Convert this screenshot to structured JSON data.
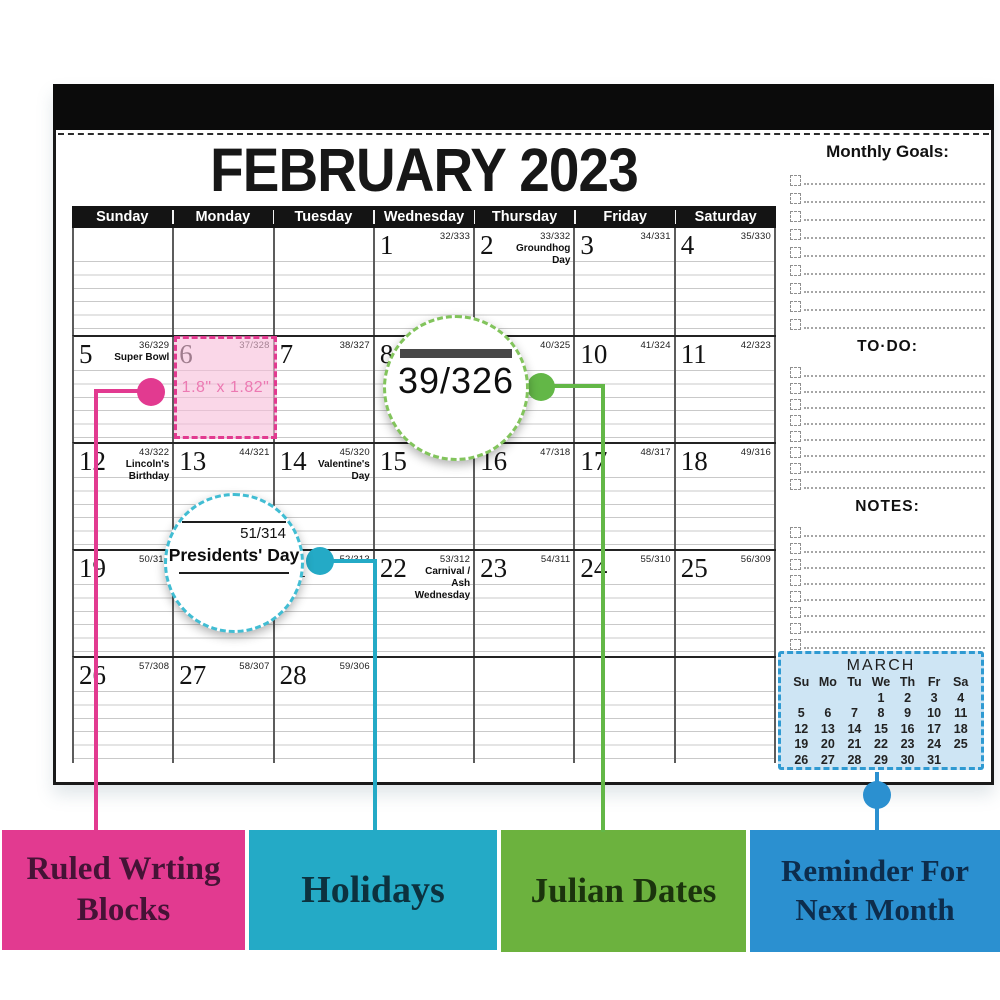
{
  "calendar": {
    "title": "FEBRUARY 2023",
    "weekdays": [
      "Sunday",
      "Monday",
      "Tuesday",
      "Wednesday",
      "Thursday",
      "Friday",
      "Saturday"
    ],
    "weeks": [
      [
        null,
        null,
        null,
        {
          "day": "1",
          "julian": "32/333"
        },
        {
          "day": "2",
          "julian": "33/332",
          "holiday": "Groundhog Day"
        },
        {
          "day": "3",
          "julian": "34/331"
        },
        {
          "day": "4",
          "julian": "35/330"
        }
      ],
      [
        {
          "day": "5",
          "julian": "36/329",
          "holiday": "Super Bowl"
        },
        {
          "day": "6",
          "julian": "37/328"
        },
        {
          "day": "7",
          "julian": "38/327"
        },
        {
          "day": "8",
          "julian": "39/326"
        },
        {
          "day": "9",
          "julian": "40/325"
        },
        {
          "day": "10",
          "julian": "41/324"
        },
        {
          "day": "11",
          "julian": "42/323"
        }
      ],
      [
        {
          "day": "12",
          "julian": "43/322",
          "holiday": "Lincoln's Birthday"
        },
        {
          "day": "13",
          "julian": "44/321"
        },
        {
          "day": "14",
          "julian": "45/320",
          "holiday": "Valentine's Day"
        },
        {
          "day": "15",
          "julian": "46/319"
        },
        {
          "day": "16",
          "julian": "47/318"
        },
        {
          "day": "17",
          "julian": "48/317"
        },
        {
          "day": "18",
          "julian": "49/316"
        }
      ],
      [
        {
          "day": "19",
          "julian": "50/315"
        },
        {
          "day": "20",
          "julian": "51/314",
          "holiday": "Presidents' Day"
        },
        {
          "day": "21",
          "julian": "52/313"
        },
        {
          "day": "22",
          "julian": "53/312",
          "holiday": "Carnival / Ash Wednesday"
        },
        {
          "day": "23",
          "julian": "54/311"
        },
        {
          "day": "24",
          "julian": "55/310"
        },
        {
          "day": "25",
          "julian": "56/309"
        }
      ],
      [
        {
          "day": "26",
          "julian": "57/308"
        },
        {
          "day": "27",
          "julian": "58/307"
        },
        {
          "day": "28",
          "julian": "59/306"
        },
        null,
        null,
        null,
        null
      ]
    ],
    "sidebar": {
      "sections": [
        {
          "heading": "Monthly Goals:",
          "lines": 9,
          "style": "big",
          "row": "h18"
        },
        {
          "heading": "TO·DO:",
          "lines": 8,
          "style": "mid",
          "row": "h16"
        },
        {
          "heading": "NOTES:",
          "lines": 8,
          "style": "mid",
          "row": "h16"
        }
      ],
      "march": {
        "title": "MARCH",
        "day_headers": [
          "Su",
          "Mo",
          "Tu",
          "We",
          "Th",
          "Fr",
          "Sa"
        ],
        "rows": [
          [
            "",
            "",
            "",
            "1",
            "2",
            "3",
            "4"
          ],
          [
            "5",
            "6",
            "7",
            "8",
            "9",
            "10",
            "11"
          ],
          [
            "12",
            "13",
            "14",
            "15",
            "16",
            "17",
            "18"
          ],
          [
            "19",
            "20",
            "21",
            "22",
            "23",
            "24",
            "25"
          ],
          [
            "26",
            "27",
            "28",
            "29",
            "30",
            "31",
            ""
          ]
        ],
        "fill_color": "#cee5f4",
        "border_color": "#2f9ad2"
      }
    }
  },
  "annotations": {
    "ruled_blocks": {
      "label": "Ruled Wrting Blocks",
      "color": "#e23a90",
      "text_color": "#451336",
      "block_label": "1.8\" x 1.82\""
    },
    "holidays": {
      "label": "Holidays",
      "color": "#24aac6",
      "text_color": "#0c323f",
      "magnifier": {
        "julian": "51/314",
        "holiday": "Presidents' Day"
      }
    },
    "julian_dates": {
      "label": "Julian Dates",
      "color": "#63b747",
      "box_color": "#6cb23e",
      "text_color": "#1b340d",
      "magnifier": {
        "value": "39/326"
      }
    },
    "reminder": {
      "label": "Reminder For Next Month",
      "color": "#2b90d0",
      "text_color": "#0d2d4d"
    }
  }
}
